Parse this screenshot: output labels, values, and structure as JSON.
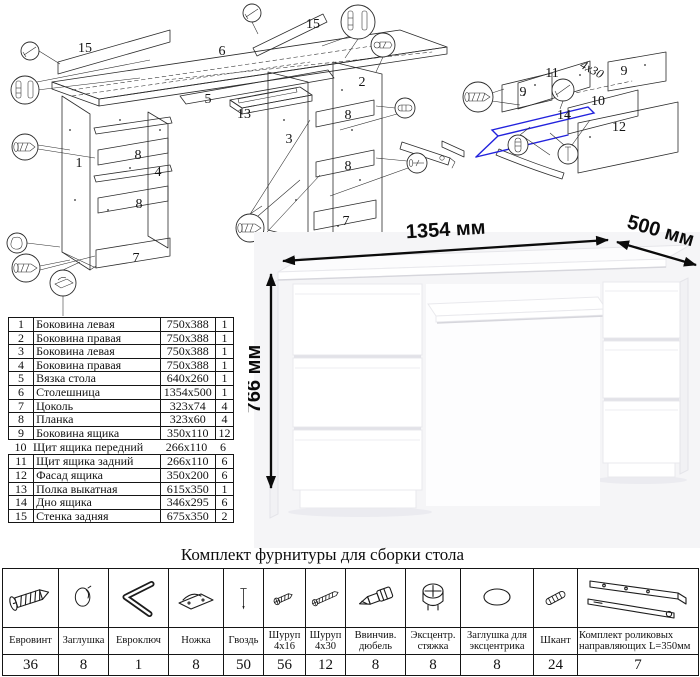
{
  "colors": {
    "accent_blue": "#2222dd",
    "line": "#2b2b2b"
  },
  "exploded_main": {
    "labels": [
      {
        "t": "15",
        "x": 85,
        "y": 52
      },
      {
        "t": "6",
        "x": 222,
        "y": 55
      },
      {
        "t": "15",
        "x": 313,
        "y": 28
      },
      {
        "t": "2",
        "x": 362,
        "y": 86
      },
      {
        "t": "5",
        "x": 208,
        "y": 103
      },
      {
        "t": "13",
        "x": 244,
        "y": 118
      },
      {
        "t": "3",
        "x": 289,
        "y": 143
      },
      {
        "t": "8",
        "x": 348,
        "y": 119
      },
      {
        "t": "1",
        "x": 79,
        "y": 167
      },
      {
        "t": "8",
        "x": 138,
        "y": 159
      },
      {
        "t": "4",
        "x": 158,
        "y": 176
      },
      {
        "t": "8",
        "x": 139,
        "y": 208
      },
      {
        "t": "8",
        "x": 348,
        "y": 170
      },
      {
        "t": "7",
        "x": 136,
        "y": 262
      },
      {
        "t": "7",
        "x": 346,
        "y": 225
      }
    ]
  },
  "exploded_drawer": {
    "labels": [
      {
        "t": "11",
        "x": 112,
        "y": 72
      },
      {
        "t": "9",
        "x": 83,
        "y": 91
      },
      {
        "t": "9",
        "x": 184,
        "y": 70
      },
      {
        "t": "10",
        "x": 158,
        "y": 100
      },
      {
        "t": "14",
        "x": 124,
        "y": 114
      },
      {
        "t": "12",
        "x": 179,
        "y": 126
      },
      {
        "t": "4x30",
        "x": 150,
        "y": 68,
        "rot": 28,
        "cls": "note"
      }
    ]
  },
  "desk": {
    "labels": [
      {
        "t": "1354 мм",
        "x": 198,
        "y": 24,
        "rot": -3.5,
        "cls": "dim"
      },
      {
        "t": "500 мм",
        "x": 411,
        "y": 25,
        "rot": 16,
        "cls": "dim"
      },
      {
        "t": "766 мм",
        "x": 12,
        "y": 167,
        "rot": -90,
        "cls": "dim"
      }
    ]
  },
  "parts_table": {
    "rows": [
      {
        "num": "1",
        "name": "Боковина левая",
        "size": "750x388",
        "qty": "1"
      },
      {
        "num": "2",
        "name": "Боковина правая",
        "size": "750x388",
        "qty": "1"
      },
      {
        "num": "3",
        "name": "Боковина левая",
        "size": "750x388",
        "qty": "1"
      },
      {
        "num": "4",
        "name": "Боковина правая",
        "size": "750x388",
        "qty": "1"
      },
      {
        "num": "5",
        "name": "Вязка стола",
        "size": "640x260",
        "qty": "1"
      },
      {
        "num": "6",
        "name": "Столешница",
        "size": "1354x500",
        "qty": "1"
      },
      {
        "num": "7",
        "name": "Цоколь",
        "size": "323x74",
        "qty": "4"
      },
      {
        "num": "8",
        "name": "Планка",
        "size": "323x60",
        "qty": "4"
      },
      {
        "num": "9",
        "name": "Боковина ящика",
        "size": "350x110",
        "qty": "12"
      },
      {
        "num": "10",
        "name": "Щит ящика передний",
        "size": "266x110",
        "qty": "6"
      },
      {
        "num": "11",
        "name": "Щит ящика задний",
        "size": "266x110",
        "qty": "6"
      },
      {
        "num": "12",
        "name": "Фасад ящика",
        "size": "350x200",
        "qty": "6"
      },
      {
        "num": "13",
        "name": "Полка выкатная",
        "size": "615x350",
        "qty": "1"
      },
      {
        "num": "14",
        "name": "Дно ящика",
        "size": "346x295",
        "qty": "6"
      },
      {
        "num": "15",
        "name": "Стенка задняя",
        "size": "675x350",
        "qty": "2"
      }
    ]
  },
  "hardware": {
    "title": "Комплект фурнитуры для сборки стола",
    "items": [
      {
        "icon": "euro-screw-icon",
        "name": "Евровинт",
        "qty": "36"
      },
      {
        "icon": "cap-icon",
        "name": "Заглушка",
        "qty": "8"
      },
      {
        "icon": "hex-key-icon",
        "name": "Евроключ",
        "qty": "1"
      },
      {
        "icon": "foot-icon",
        "name": "Ножка",
        "qty": "8"
      },
      {
        "icon": "nail-icon",
        "name": "Гвоздь",
        "qty": "50"
      },
      {
        "icon": "screw-16-icon",
        "name": "Шуруп 4x16",
        "qty": "56"
      },
      {
        "icon": "screw-30-icon",
        "name": "Шуруп 4x30",
        "qty": "12"
      },
      {
        "icon": "dowel-screw-icon",
        "name": "Ввинчив. дюбель",
        "qty": "8"
      },
      {
        "icon": "cam-lock-icon",
        "name": "Эксцентр. стяжка",
        "qty": "8"
      },
      {
        "icon": "cam-cap-icon",
        "name": "Заглушка для эксцентрика",
        "qty": "8"
      },
      {
        "icon": "wood-dowel-icon",
        "name": "Шкант",
        "qty": "24"
      },
      {
        "icon": "drawer-rails-icon",
        "name": "Комплект роликовых направляющих L=350мм",
        "qty": "7"
      }
    ]
  }
}
